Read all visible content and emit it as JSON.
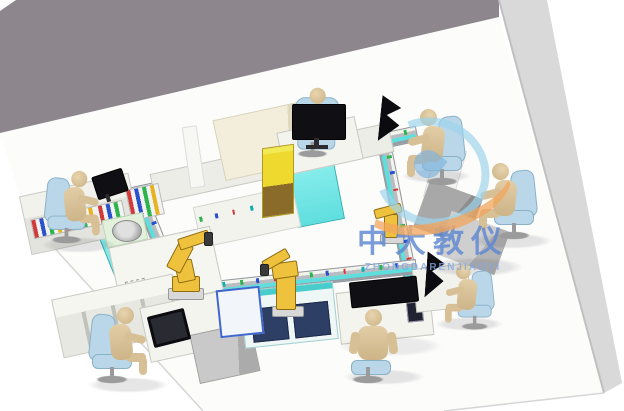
{
  "watermark": {
    "text_cn": "中大教仪",
    "text_en": "ZHONGDARENJIAOYI",
    "logo": "blue-ring-orange-swoosh-logo"
  },
  "colors": {
    "wall_back": "#8d868c",
    "wall_right": "#d9d9d9",
    "floor": "#fcfcfb",
    "floor_line": "#d6d6d6",
    "conveyor_frame": "#b9bcc0",
    "belt": "#5fdede",
    "belt_light": "#8ff0ee",
    "bench_white": "#f4f4ef",
    "cabinet_navy": "#2e3f66",
    "cabinet_gray": "#bdbdbd",
    "desk_dark_gray": "#9c9c9c",
    "backdrop_beige": "#f3eedb",
    "tower_yellow": "#eed92e",
    "tower_base": "#8a6b2a",
    "robot_yellow": "#eec23d",
    "robot_edge": "#8f6d16",
    "skin": "#d9c29c",
    "chair_blue": "#b9d7e8",
    "chair_edge": "#8ab0c8",
    "monitor_black": "#101014",
    "dot_green": "#2bb54c",
    "dot_blue": "#2a52cc",
    "dot_red": "#d23a3a",
    "wm_blue": "#5b8fd9",
    "logo_blue": "#9ed4ec",
    "logo_orange": "#f2a65e"
  },
  "scene": {
    "description": "isometric 3D render of a closed-loop flexible-manufacturing training line in a room",
    "walls": [
      "back-wall",
      "right-wall"
    ],
    "conveyor_loop_segments": [
      "top",
      "right",
      "bottom",
      "left"
    ],
    "robots": [
      "articulated-robot-left",
      "articulated-robot-bottom-center",
      "articulated-robot-right"
    ],
    "operators": [
      "operator-top-left",
      "operator-top-center",
      "operator-upper-right",
      "operator-right",
      "operator-mid-right",
      "operator-bottom-center",
      "operator-bottom-left"
    ],
    "workstations": [
      "control-panel-bench",
      "robot-table-left",
      "cabinet-bench-bottom-left",
      "laptop-desk",
      "side-cabinet",
      "navy-cabinet-bottom-center",
      "blue-frame-unit",
      "console-desk",
      "flag-display-desk",
      "gray-desk-right",
      "supervisor-desk-top",
      "inner-bench",
      "back-bench-row",
      "beige-backdrop",
      "yellow-storage-tower"
    ],
    "displays": [
      "monitor-top-left",
      "monitor-top-center",
      "flag-display-upper-right",
      "flag-display-mid-right",
      "console-monitor",
      "laptop-bottom-left"
    ]
  }
}
